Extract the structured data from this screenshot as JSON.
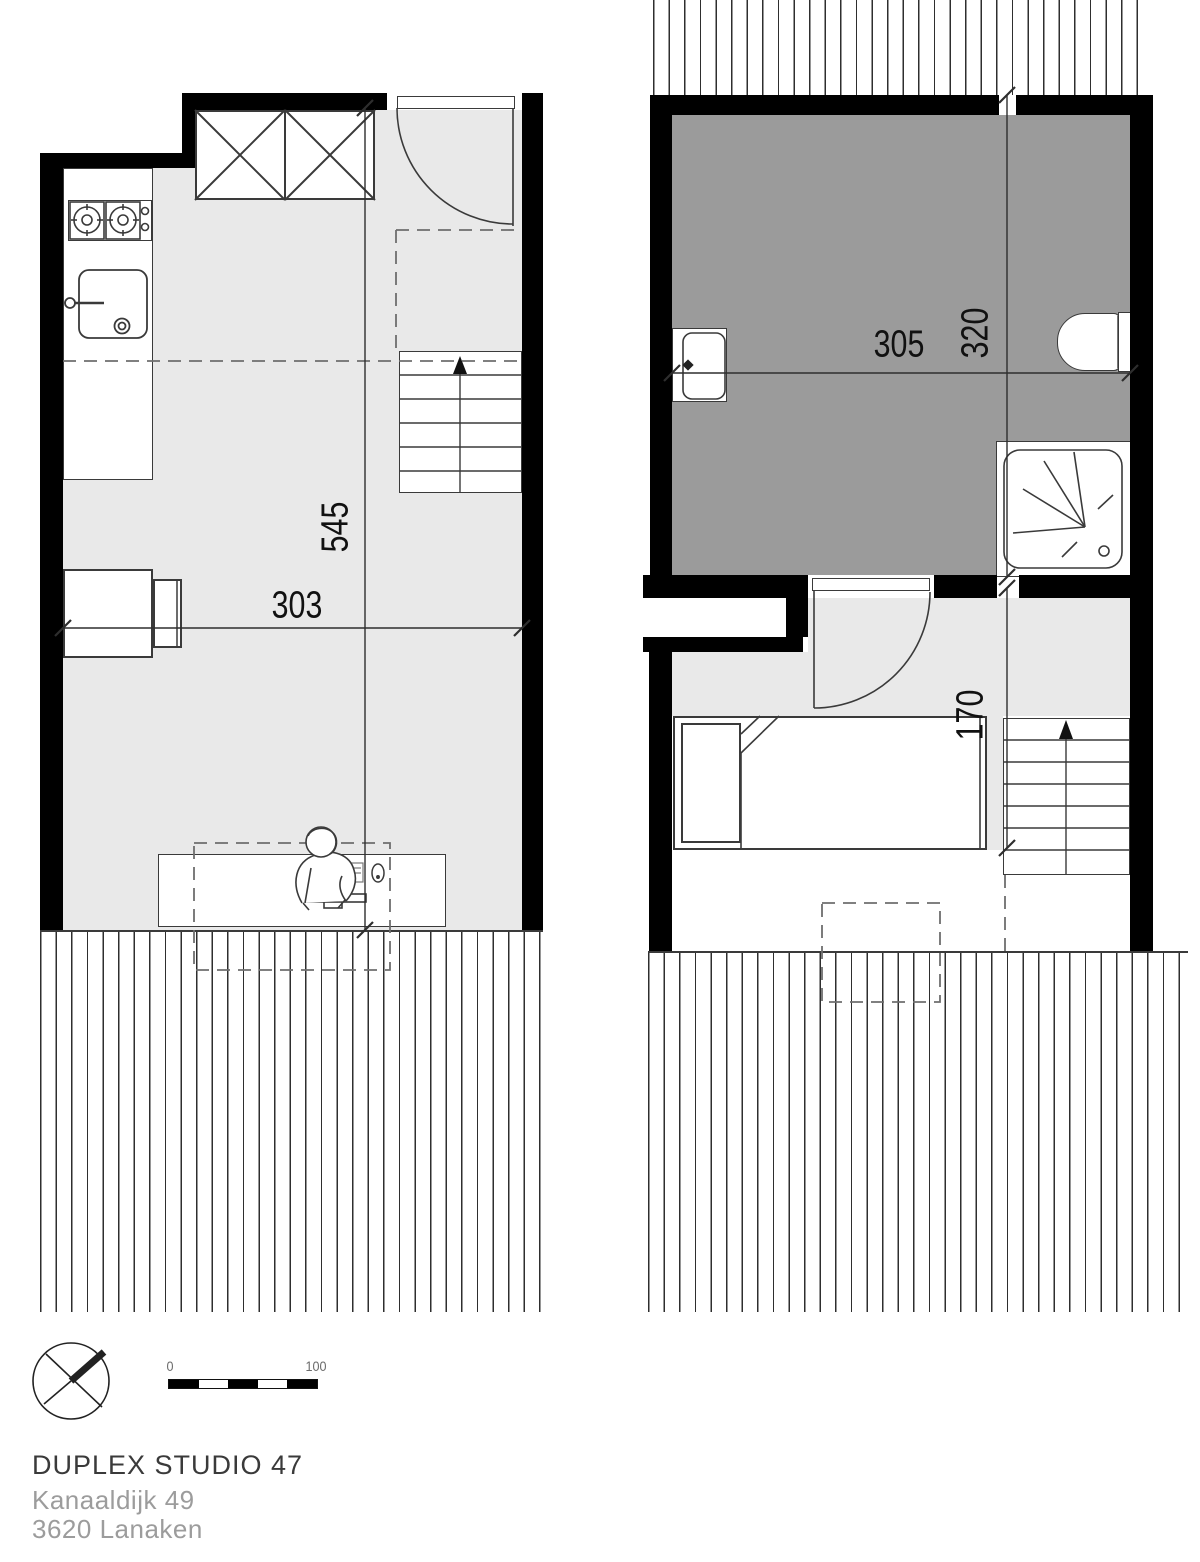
{
  "document": {
    "type": "architectural-floor-plan",
    "sheets": "duplex studio, two levels"
  },
  "plans": {
    "ground_floor": {
      "label": "ground-floor-plan",
      "dim_width": "303",
      "dim_height": "545",
      "features": [
        "kitchen-stove",
        "kitchen-sink",
        "wardrobe",
        "entry-door",
        "stairs-up",
        "sofa-bed",
        "desk",
        "person-figure",
        "terrace-decking"
      ]
    },
    "upper_floor": {
      "label": "upper-floor-plan",
      "dim_width": "305",
      "dim_height": "320",
      "dim_hall": "170",
      "features": [
        "bathroom",
        "washbasin",
        "toilet",
        "shower",
        "interior-door",
        "bed",
        "stairs-up",
        "roof-decking",
        "skylight-dashed"
      ]
    }
  },
  "scale_bar": {
    "start_label": "0",
    "end_label": "100"
  },
  "title_block": {
    "title": "DUPLEX STUDIO 47",
    "address_line_1": "Kanaaldijk 49",
    "address_line_2": "3620 Lanaken"
  },
  "colors": {
    "wall": "#000000",
    "floor_light": "#e9e9e9",
    "floor_dark": "#9b9b9b",
    "line": "#333333",
    "text_primary": "#3a3a3a",
    "text_muted": "#9c9c9c"
  }
}
